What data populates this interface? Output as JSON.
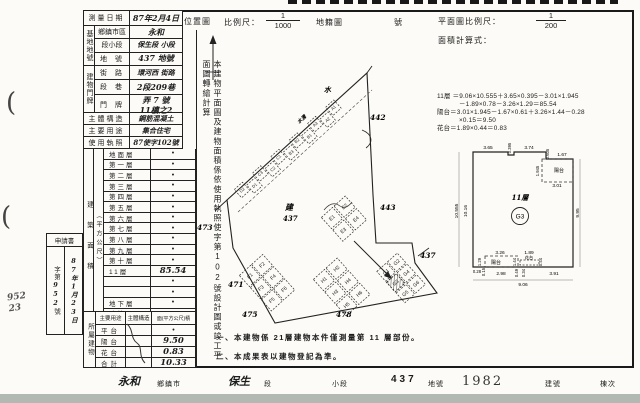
{
  "margin": {
    "paren1": "(",
    "paren2": "(",
    "hand_note": "952 23"
  },
  "header": {
    "location_map": "位置圖",
    "scale_label": "比例尺：",
    "loc_scale_num": "1",
    "loc_scale_den": "1000",
    "cadastral_label": "地籍圖",
    "number_label": "號",
    "plan_scale_label": "平面圖比例尺：",
    "plan_scale_num": "1",
    "plan_scale_den": "200",
    "calc_label": "面積計算式："
  },
  "calc": {
    "lines": [
      "11層 ＝9.06×10.555＋3.65×0.395－3.01×1.945",
      "－1.89×0.78－3.26×1.29＝85.54",
      "陽台＝3.01×1.945－1.67×0.61＋3.26×1.44－0.28",
      "×0.15＝9.50",
      "花台＝1.89×0.44＝0.83"
    ]
  },
  "table": {
    "survey": {
      "label": "測量日期",
      "value": "87年2月4日"
    },
    "site_group": "基地地號",
    "site_rows": [
      {
        "label": "鄉鎮市區",
        "value": "永和"
      },
      {
        "label": "段小段",
        "value": "保生段 小段"
      },
      {
        "label": "地號",
        "value": "437 地號"
      }
    ],
    "addr_group": "建物門牌",
    "addr_rows": [
      {
        "label": "街路",
        "value": "環河西 街路"
      },
      {
        "label": "段巷",
        "value": "2段209巷"
      }
    ],
    "door": {
      "label": "門牌",
      "line1": "弄 7 號",
      "line2": "11樓之2"
    },
    "structure": {
      "label": "主體構造",
      "value": "鋼筋混凝土"
    },
    "usage": {
      "label": "主要用途",
      "value": "集合住宅"
    },
    "license": {
      "label": "使用執照",
      "value": "87使字102號"
    },
    "floors_group": "建築面積",
    "floors_unit": "（平方公尺）",
    "floors": [
      {
        "label": "地面層",
        "value": "•"
      },
      {
        "label": "第一層",
        "value": "•"
      },
      {
        "label": "第二層",
        "value": "•"
      },
      {
        "label": "第三層",
        "value": "•"
      },
      {
        "label": "第四層",
        "value": "•"
      },
      {
        "label": "第五層",
        "value": "•"
      },
      {
        "label": "第六層",
        "value": "•"
      },
      {
        "label": "第七層",
        "value": "•"
      },
      {
        "label": "第八層",
        "value": "•"
      },
      {
        "label": "第九層",
        "value": "•"
      },
      {
        "label": "第十層",
        "value": "•"
      },
      {
        "label": "11層",
        "value": "85.54"
      },
      {
        "label": "",
        "value": "•"
      },
      {
        "label": "",
        "value": "•"
      },
      {
        "label": "地下層",
        "value": "•"
      },
      {
        "label": "騎樓",
        "value": "•"
      },
      {
        "label": "合計",
        "value": "85.54"
      }
    ],
    "annex_group": "所屬建物",
    "annex_header": {
      "c1": "主要用途",
      "c2": "主體構造",
      "c3": "面(平方公尺)積"
    },
    "annex_rows": [
      {
        "label": "平台",
        "value": "•"
      },
      {
        "label": "陽台",
        "value": "9.50"
      },
      {
        "label": "花台",
        "value": "0.83"
      },
      {
        "label": "合計",
        "value": "10.33"
      }
    ]
  },
  "app_box": {
    "title": "申請書",
    "no_prefix": "字第",
    "no": "952",
    "no_suffix": "號",
    "date": "87年1月23日"
  },
  "vertical_note": "本建物平面圖及建物面積係依使用執照使字第102號設計圖或竣工平面圖轉繪計算",
  "notes": [
    "一、本建物係 21層建物本件僅測量第 11 層部份。",
    "二、本成果表以建物登記為準。"
  ],
  "map": {
    "water": "水",
    "ditch": "水溝",
    "center_mark": "建",
    "center_lot": "437",
    "lots": {
      "a": "442",
      "b": "443",
      "c": "437",
      "d": "471",
      "e": "475",
      "f": "478",
      "g": "473"
    },
    "units": {
      "strip": [
        "D2",
        "D1",
        "C3",
        "C2",
        "C1",
        "B3",
        "B2",
        "B1",
        "A3",
        "A2",
        "A1"
      ],
      "top": [
        "E1",
        "E2",
        "E3",
        "E4"
      ],
      "left": [
        "F1",
        "F2",
        "F3",
        "F4",
        "F5",
        "F6"
      ],
      "mid": [
        "H1",
        "H2",
        "H3",
        "H4",
        "H5",
        "H6"
      ],
      "right": [
        "G1",
        "G2",
        "G3",
        "G4",
        "G5",
        "G6"
      ],
      "target": "G3"
    }
  },
  "plan": {
    "floor_label": "11層",
    "unit_label": "G3",
    "balcony_label": "陽台",
    "flower_label": "花台",
    "dims": {
      "t_365": "3.65",
      "t_0395": "0.395",
      "t_374": "3.74",
      "t_0605": "0.605",
      "t_167": "1.67",
      "l_outer": "10.555",
      "l_inner": "10.16",
      "r_side": "9.95",
      "in_v": "1.945",
      "in_h": "3.01",
      "b_326": "3.26",
      "b_129": "1.29",
      "b_144": "1.44",
      "b_189": "1.89",
      "b_044": "0.44",
      "b_028": "0.28",
      "b_015": "0.15",
      "b_298": "2.98",
      "b_049": "0.49",
      "b_034": "0.34",
      "b_391": "3.91",
      "b_total": "9.06"
    }
  },
  "footer": {
    "name1": "永和",
    "label1": "鄉鎮市",
    "name2": "保生",
    "label2": "段",
    "label3": "小段",
    "lot": "437",
    "label4": "地號",
    "build_no": "1982",
    "label5": "建號",
    "label6": "棟次"
  }
}
